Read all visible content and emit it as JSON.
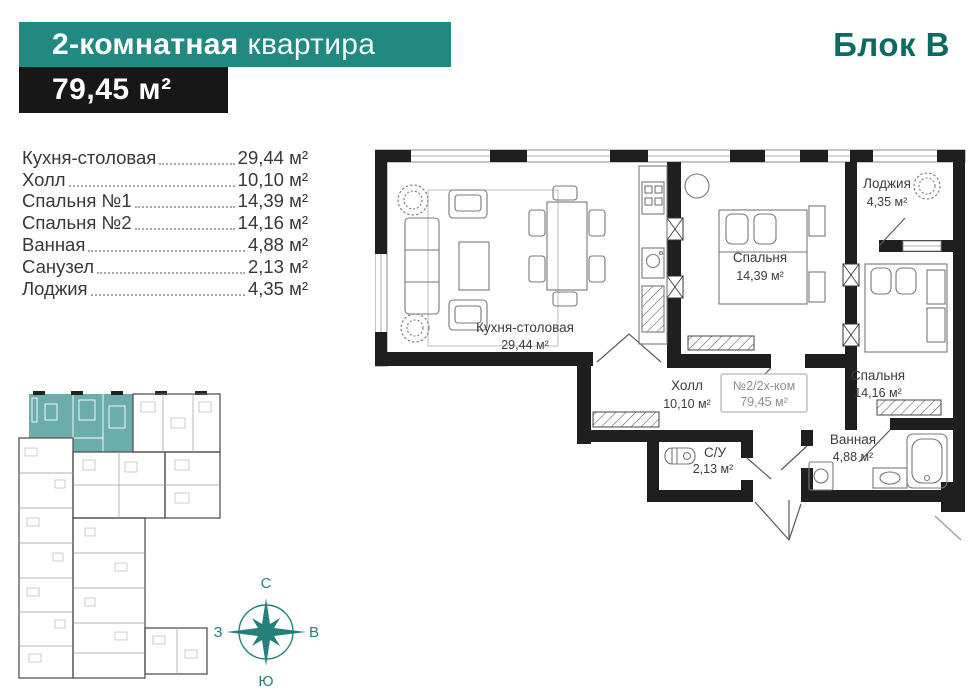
{
  "header": {
    "title_bold": "2-комнатная",
    "title_light": "квартира",
    "total_area": "79,45 м²",
    "block": "Блок В"
  },
  "rooms": [
    {
      "name": "Кухня-столовая",
      "area": "29,44 м²"
    },
    {
      "name": "Холл",
      "area": "10,10 м²"
    },
    {
      "name": "Спальня №1",
      "area": "14,39 м²"
    },
    {
      "name": "Спальня №2",
      "area": "14,16 м²"
    },
    {
      "name": "Ванная",
      "area": "4,88 м²"
    },
    {
      "name": "Санузел",
      "area": "2,13 м²"
    },
    {
      "name": "Лоджия",
      "area": "4,35 м²"
    }
  ],
  "plan": {
    "kitchen": {
      "name": "Кухня-столовая",
      "area": "29,44 м²"
    },
    "hall": {
      "name": "Холл",
      "area": "10,10 м²"
    },
    "bedroom1": {
      "name": "Спальня",
      "area": "14,39 м²"
    },
    "bedroom2": {
      "name": "Спальня",
      "area": "14,16 м²"
    },
    "loggia": {
      "name": "Лоджия",
      "area": "4,35 м²"
    },
    "bathroom": {
      "name": "Ванная",
      "area": "4,88 м²"
    },
    "wc": {
      "name": "С/У",
      "area": "2,13 м²"
    },
    "badge": {
      "line1": "№2/2х-ком",
      "line2": "79,45 м²"
    }
  },
  "compass": {
    "north": "С",
    "south": "Ю",
    "west": "З",
    "east": "В"
  },
  "colors": {
    "teal_bar": "#21897f",
    "black_bar": "#171717",
    "block_text": "#0d6a62",
    "wall": "#1f1f1f",
    "plan_text": "#3c3c3c",
    "badge_text": "#8f8f8f",
    "mini_highlight": "#6badaa",
    "compass": "#26807a"
  }
}
